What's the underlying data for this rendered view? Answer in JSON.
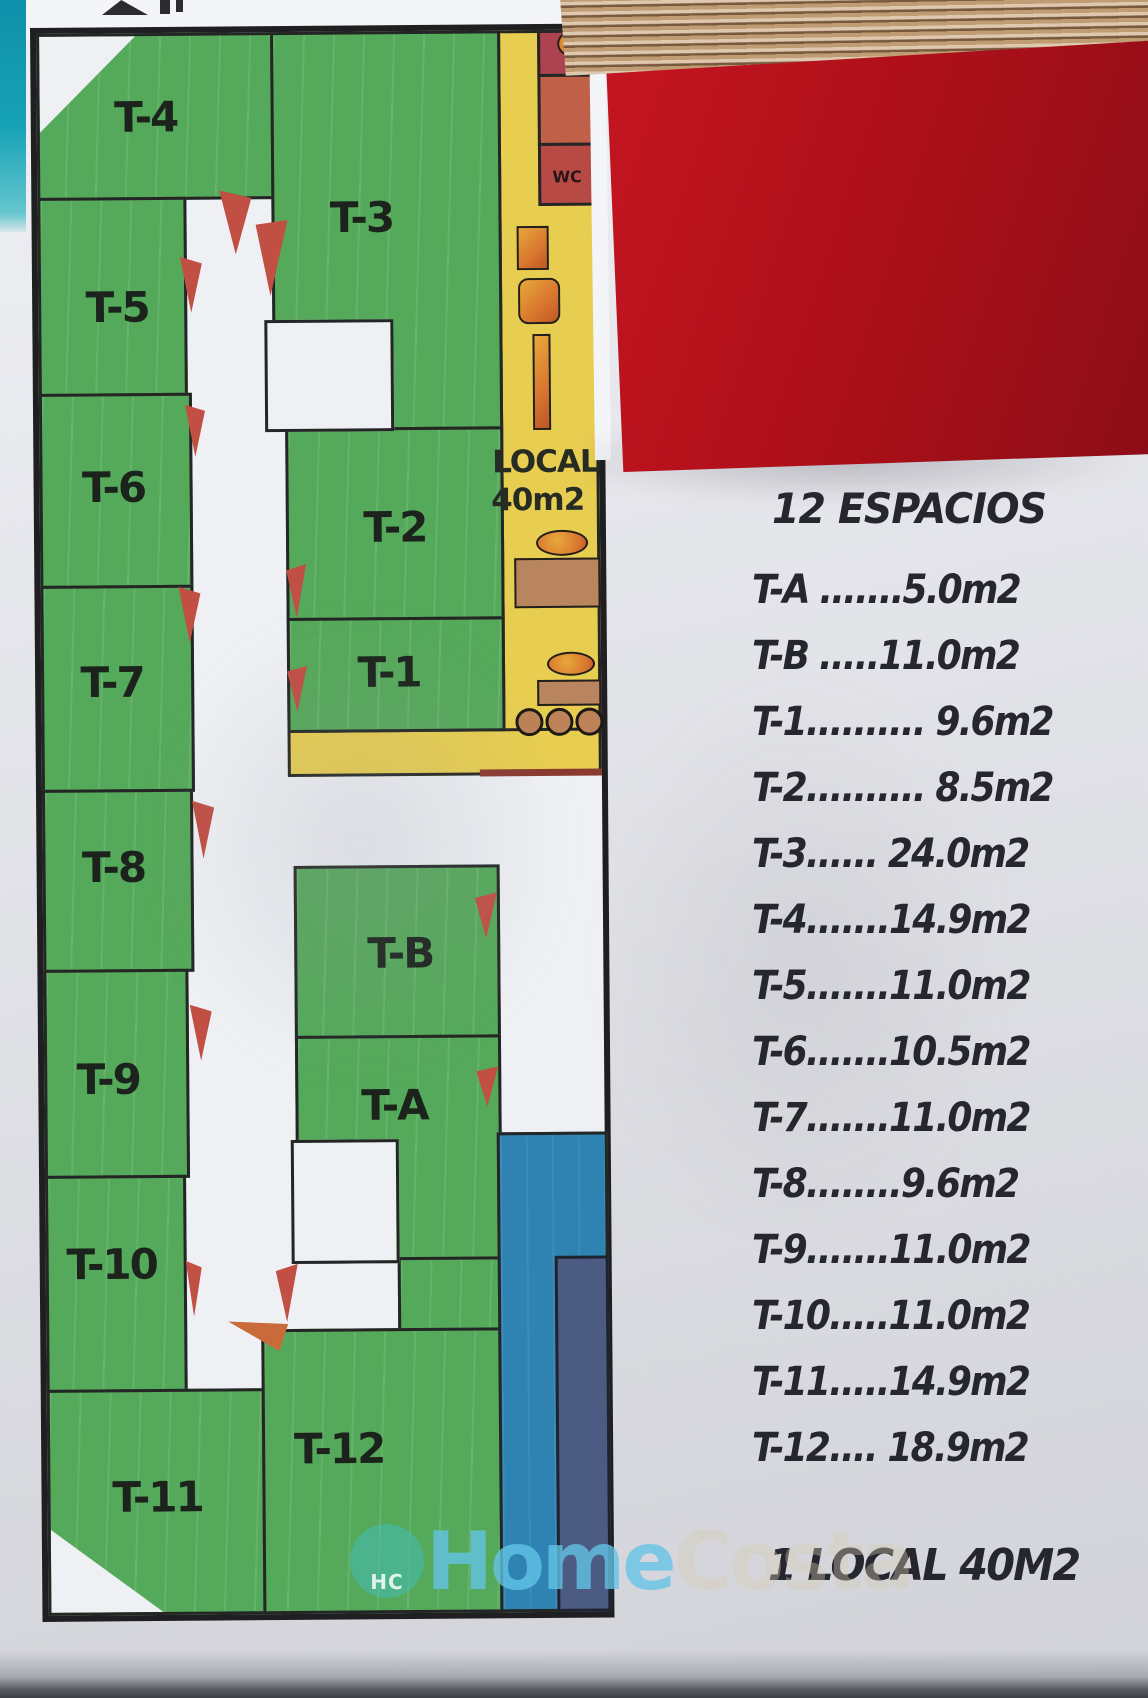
{
  "plan": {
    "rooms": [
      {
        "id": "t4",
        "label": "T-4"
      },
      {
        "id": "t3",
        "label": "T-3"
      },
      {
        "id": "t5",
        "label": "T-5"
      },
      {
        "id": "t6",
        "label": "T-6"
      },
      {
        "id": "t2",
        "label": "T-2"
      },
      {
        "id": "t1",
        "label": "T-1"
      },
      {
        "id": "t7",
        "label": "T-7"
      },
      {
        "id": "t8",
        "label": "T-8"
      },
      {
        "id": "tb",
        "label": "T-B"
      },
      {
        "id": "t9",
        "label": "T-9"
      },
      {
        "id": "ta",
        "label": "T-A"
      },
      {
        "id": "t10",
        "label": "T-10"
      },
      {
        "id": "t11",
        "label": "T-11"
      },
      {
        "id": "t12",
        "label": "T-12"
      }
    ],
    "wc_label": "WC",
    "local_label": "LOCAL",
    "local_area": "40m2"
  },
  "legend": {
    "title": "12 ESPACIOS",
    "items": [
      "T-A .......5.0m2",
      "T-B .....11.0m2",
      "T-1.......... 9.6m2",
      "T-2.......... 8.5m2",
      "T-3...... 24.0m2",
      "T-4.......14.9m2",
      "T-5.......11.0m2",
      "T-6.......10.5m2",
      "T-7.......11.0m2",
      "T-8........9.6m2",
      "T-9.......11.0m2",
      "T-10.....11.0m2",
      "T-11.....14.9m2",
      "T-12.... 18.9m2"
    ],
    "footer": "1 LOCAL 40M2"
  },
  "watermark": {
    "initials": "HC",
    "word1": "Home",
    "word2": "Costa"
  },
  "colors": {
    "room_green": "#55a95a",
    "corridor_yellow": "#e8ce50",
    "wc_red": "#b84a45",
    "pool_blue": "#2e83b2",
    "pool_navy": "#4b5b82",
    "door_red": "#c14f44",
    "book_red": "#ae1019",
    "table_teal": "#17a2b6"
  }
}
